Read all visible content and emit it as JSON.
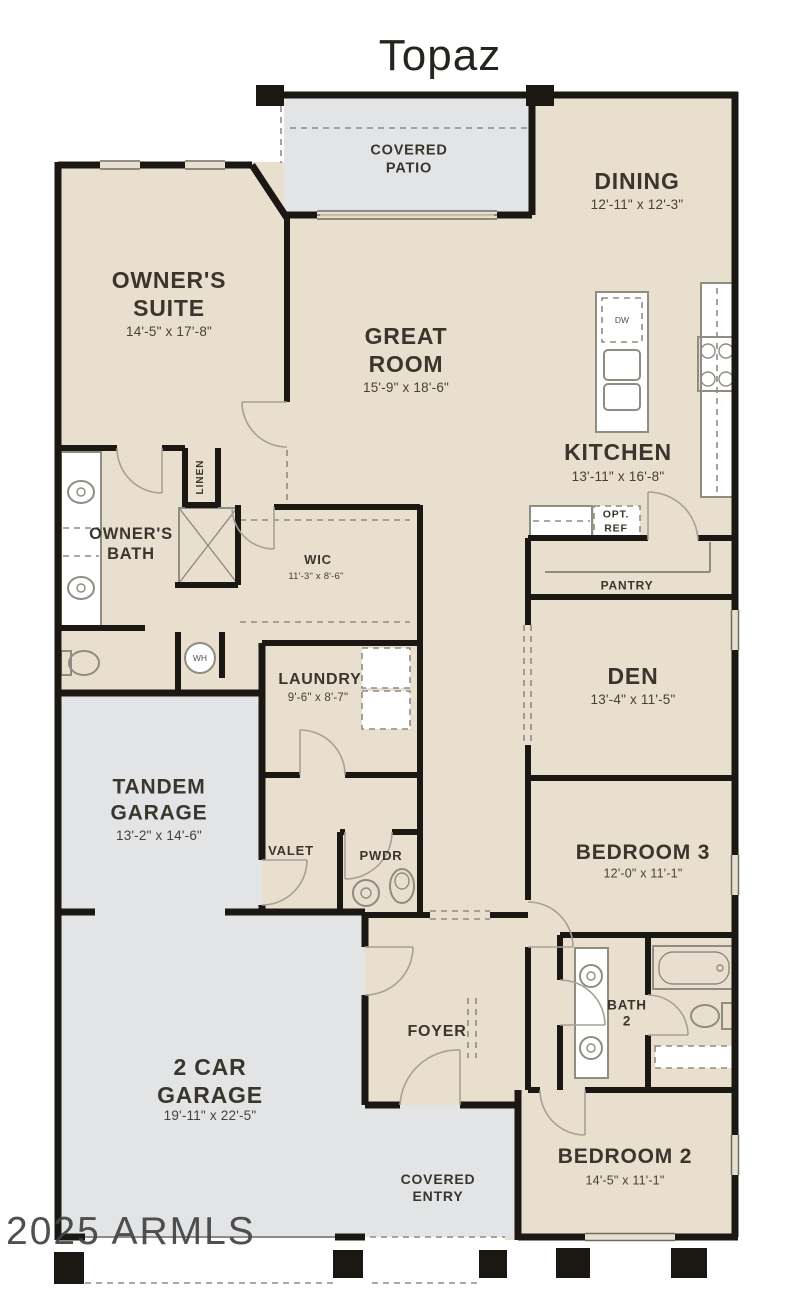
{
  "title": "Topaz",
  "watermark": "2025 ARMLS",
  "colors": {
    "room_fill": "#e8dfce",
    "outdoor_fill": "#e2e4e6",
    "wall": "#1b1713",
    "fixture_outline": "#8f8c83",
    "text": "#3a362e"
  },
  "rooms": {
    "covered_patio": {
      "name": "COVERED\nPATIO"
    },
    "dining": {
      "name": "DINING",
      "dims": "12'-11\" x 12'-3\""
    },
    "owners_suite": {
      "name": "OWNER'S\nSUITE",
      "dims": "14'-5\" x 17'-8\""
    },
    "great_room": {
      "name": "GREAT\nROOM",
      "dims": "15'-9\" x 18'-6\""
    },
    "kitchen": {
      "name": "KITCHEN",
      "dims": "13'-11\" x 16'-8\""
    },
    "owners_bath": {
      "name": "OWNER'S\nBATH"
    },
    "linen": {
      "name": "LINEN"
    },
    "wic": {
      "name": "WIC",
      "dims": "11'-3\" x 8'-6\""
    },
    "laundry": {
      "name": "LAUNDRY",
      "dims": "9'-6\" x 8'-7\""
    },
    "opt_ref": {
      "name": "OPT.\nREF"
    },
    "pantry": {
      "name": "PANTRY"
    },
    "den": {
      "name": "DEN",
      "dims": "13'-4\" x 11'-5\""
    },
    "tandem_garage": {
      "name": "TANDEM\nGARAGE",
      "dims": "13'-2\" x 14'-6\""
    },
    "valet": {
      "name": "VALET"
    },
    "pwdr": {
      "name": "PWDR"
    },
    "bedroom3": {
      "name": "BEDROOM 3",
      "dims": "12'-0\" x 11'-1\""
    },
    "bath2": {
      "name": "BATH\n2"
    },
    "foyer": {
      "name": "FOYER"
    },
    "two_car_garage": {
      "name": "2 CAR\nGARAGE",
      "dims": "19'-11\" x 22'-5\""
    },
    "covered_entry": {
      "name": "COVERED\nENTRY"
    },
    "bedroom2": {
      "name": "BEDROOM 2",
      "dims": "14'-5\" x 11'-1\""
    }
  },
  "appliances": {
    "dishwasher": "DW",
    "water_heater": "WH"
  }
}
